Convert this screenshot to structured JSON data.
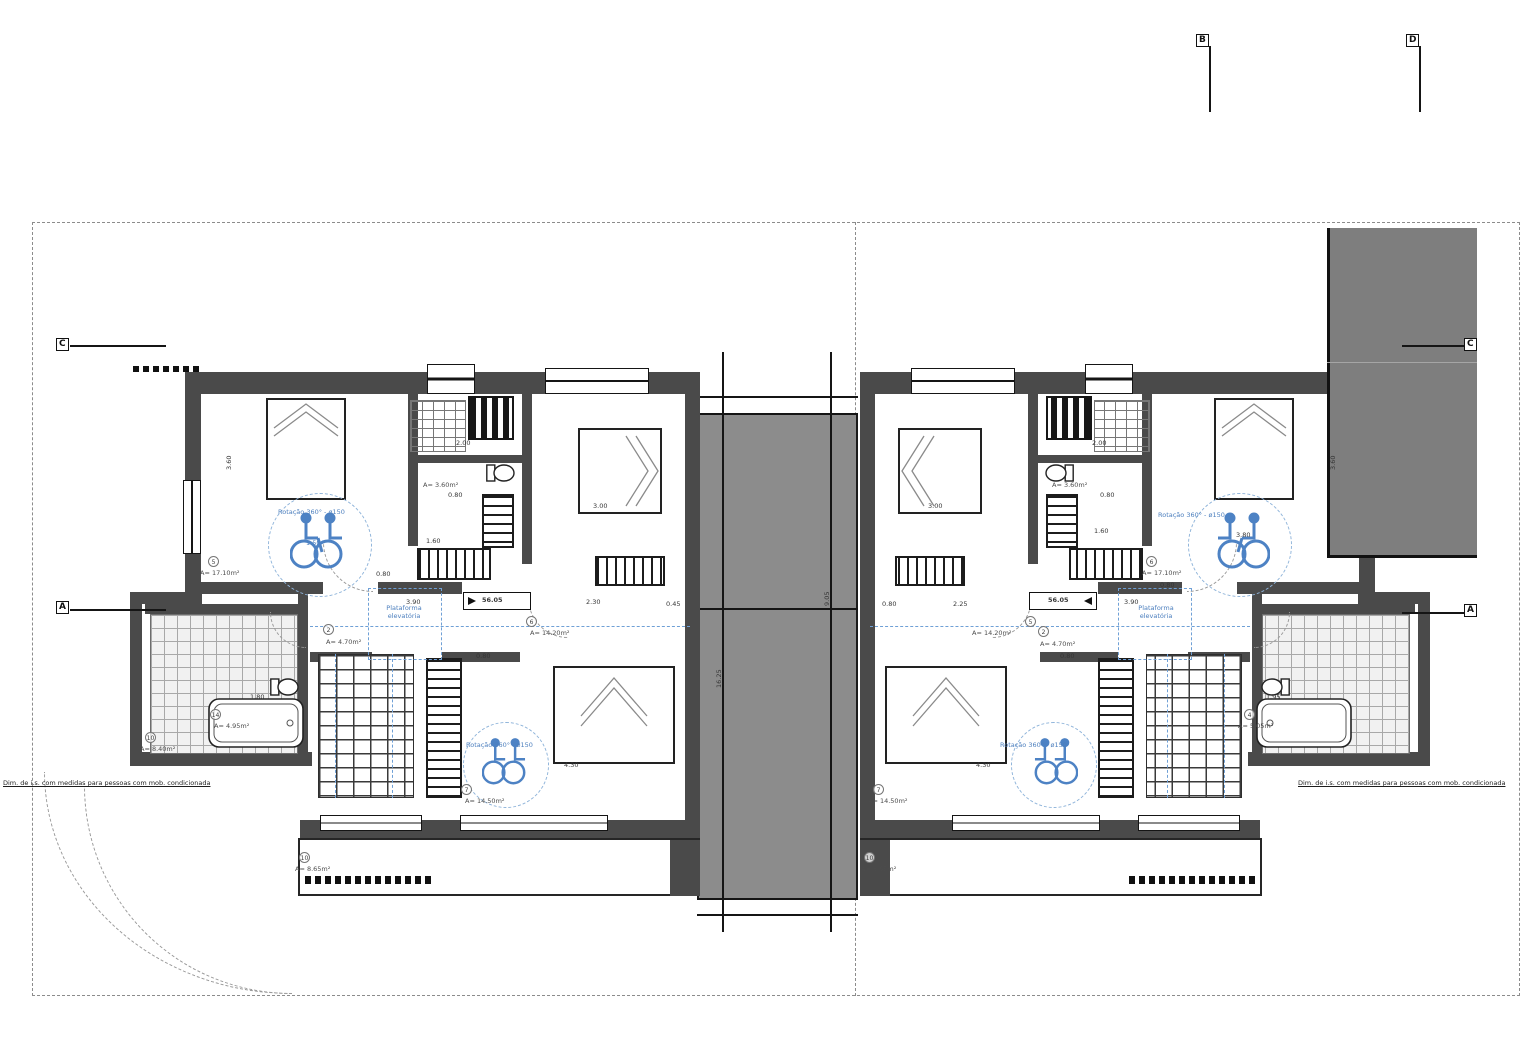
{
  "markers": {
    "b": "B",
    "d": "D",
    "c": "C",
    "a": "A"
  },
  "center": {
    "dim_main": "16.25",
    "dim_patio": "9.05"
  },
  "note": "Dim. de i.s. com medidas para pessoas com mob. condicionada",
  "house1": {
    "master_rot": "Rotação 360° - ø150",
    "master_rot_d": "1.50",
    "master_tag": "5",
    "master_area": "A= 17.10m²",
    "master_h": "3.60",
    "wc_area": "A= 3.60m²",
    "wc_d1": "2.00",
    "wc_d2": "0.80",
    "wc_d3": "1.60",
    "mid_tag": "6",
    "mid_area": "A= 14.20m²",
    "mid_bed_w": "3.00",
    "mid_d1": "2.30",
    "mid_d2": "0.45",
    "hall_tag": "2",
    "hall_area": "A= 4.70m²",
    "hall_w": "3.90",
    "hall_d1": "0.80",
    "hall_d2": "0.80",
    "level": "56.05",
    "lift": "Plataforma elevatória",
    "bath_tag": "14",
    "bath_area": "A= 4.95m²",
    "bath_d": "1.80",
    "side_tag": "10",
    "side_area": "A= 8.40m²",
    "b7_tag": "7",
    "b7_area": "A= 14.50m²",
    "b7_rot": "Rotação 360° - ø150",
    "b7_w": "4.30",
    "balc_tag": "10",
    "balc_area": "A= 8.65m²"
  },
  "house2": {
    "master_rot": "Rotação 360° - ø150",
    "master_tag": "6",
    "master_area": "A= 17.10m²",
    "master_h": "3.60",
    "master_d1": "1.60",
    "master_d2": "3.80",
    "master_d3": "0.80",
    "wc_area": "A= 3.60m²",
    "wc_d1": "2.00",
    "wc_d2": "0.80",
    "mid_tag": "5",
    "mid_area": "A= 14.20m²",
    "mid_bed_w": "3.00",
    "corr": "2.25",
    "corr2": "0.80",
    "hall_tag": "2",
    "hall_area": "A= 4.70m²",
    "hall_w": "3.90",
    "hall_d1": "0.80",
    "level": "56.05",
    "lift": "Plataforma elevatória",
    "bath_tag": "4",
    "bath_area": "A= 5.05m²",
    "bath_d": "1.95",
    "b7_tag": "7",
    "b7_area": "A= 14.50m²",
    "b7_rot": "Rotação 360° - ø150",
    "b7_w": "4.30",
    "balc_tag": "10",
    "balc_area": "A= 8.65m²"
  }
}
